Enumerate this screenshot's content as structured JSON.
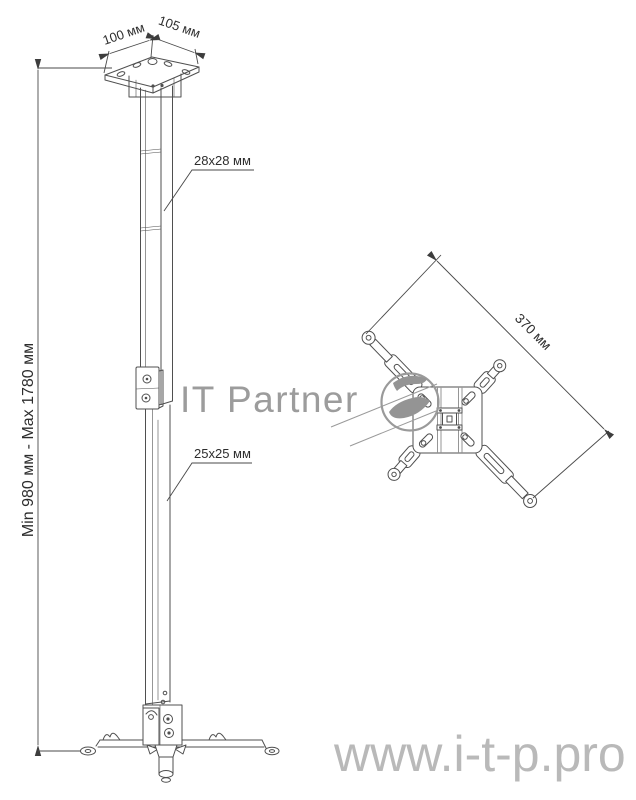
{
  "labels": {
    "plate_depth": "100 мм",
    "plate_width": "105 мм",
    "outer_tube": "28x28 мм",
    "inner_tube": "25x25 мм",
    "height_range": "Min 980 мм - Max 1780 мм",
    "bracket_span": "370 мм"
  },
  "watermark": {
    "brand": "IT Partner",
    "website": "www.i-t-p.pro"
  },
  "icons": {
    "logo": "itp-swoosh-circle-logo"
  },
  "colors": {
    "drawing_line": "#4f4f4f",
    "dimension_text": "#2d2d2d",
    "watermark_brand": "#9c9c9c",
    "watermark_url": "#b9b9b9",
    "background": "#ffffff"
  }
}
